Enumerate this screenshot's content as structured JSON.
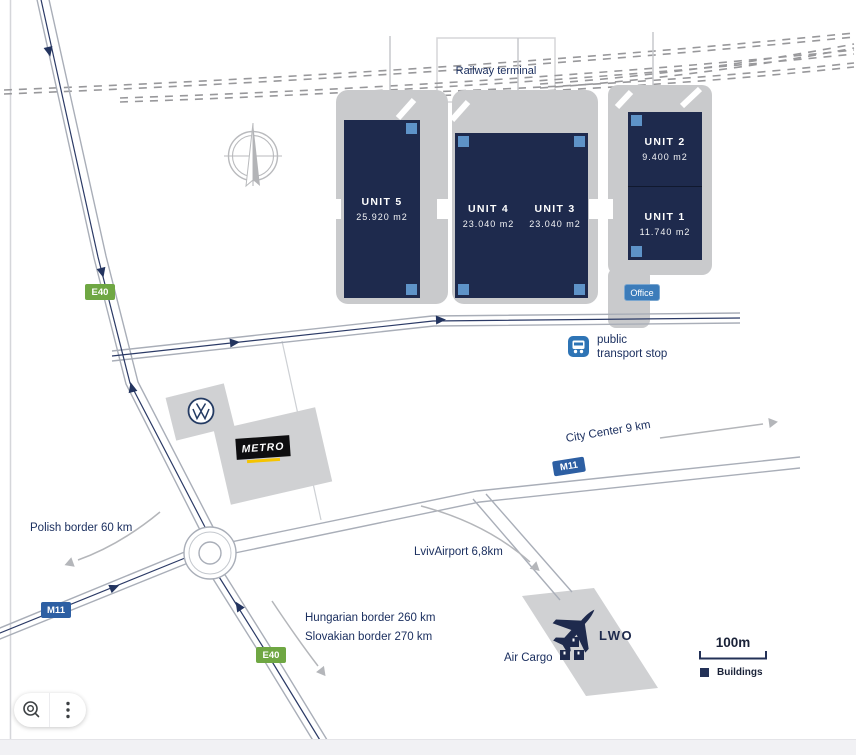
{
  "labels": {
    "railway_terminal": "Railway terminal",
    "public_transport_line1": "public",
    "public_transport_line2": "transport stop",
    "city_center": "City Center 9 km",
    "polish_border": "Polish border 60 km",
    "hungarian_border": "Hungarian border 260 km",
    "slovakian_border": "Slovakian border 270 km",
    "lviv_airport": "LvivAirport 6,8km",
    "air_cargo": "Air Cargo",
    "airport_code": "LWO",
    "office": "Office"
  },
  "units": [
    {
      "name": "UNIT 5",
      "area": "25.920 m2"
    },
    {
      "name": "UNIT 4",
      "area": "23.040 m2"
    },
    {
      "name": "UNIT 3",
      "area": "23.040 m2"
    },
    {
      "name": "UNIT 2",
      "area": "9.400 m2"
    },
    {
      "name": "UNIT 1",
      "area": "11.740 m2"
    }
  ],
  "road_badges": {
    "e40": "E40",
    "m11": "M11"
  },
  "logos": {
    "metro": "METRO",
    "vw": "VW"
  },
  "legend": {
    "scale": "100m",
    "buildings": "Buildings"
  },
  "icons": {
    "compass": "compass-rose",
    "bus": "public-transport-bus",
    "plane": "airplane",
    "cargo": "cargo-boxes",
    "magnifier": "zoom-lens",
    "kebab": "three-dot-menu",
    "vw_roundel": "vw-logo"
  },
  "colors": {
    "building_navy": "#1e2a4d",
    "corner_blue": "#5e93c8",
    "office_blue": "#3c7cba",
    "transport_blue": "#2e74b5",
    "e40_green": "#6fa743",
    "m11_blue": "#2d5fa3",
    "platform_gray": "#c9cacc",
    "label_navy": "#1c3060"
  }
}
